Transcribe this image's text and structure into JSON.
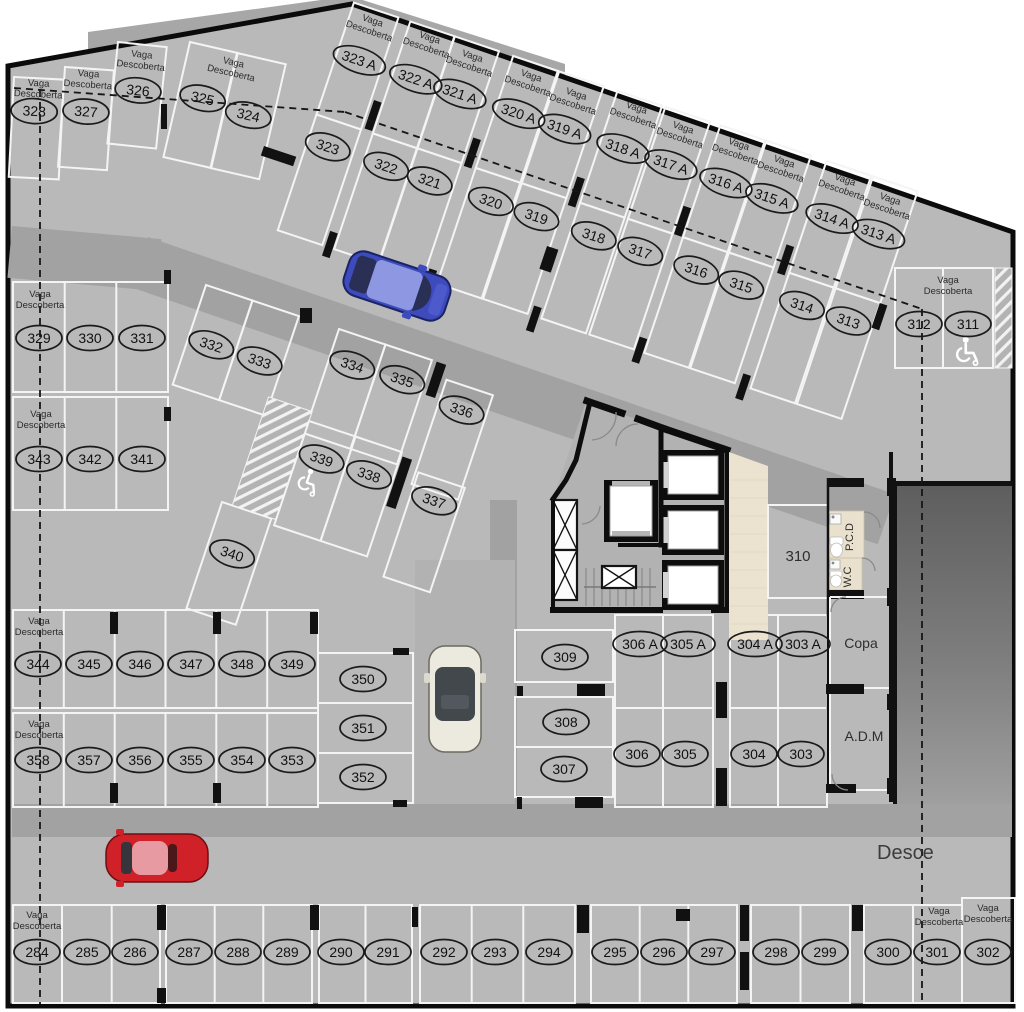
{
  "labels": {
    "uncovered_space": "Vaga Descoberta",
    "ramp_direction": "Desce"
  },
  "rooms": {
    "storage_unit": "310",
    "pantry": "Copa",
    "admin": "A.D.M",
    "wc": "W.C",
    "accessible_wc": "P.C.D"
  },
  "stalls": {
    "upper_left": [
      "328",
      "327",
      "326",
      "325",
      "324"
    ],
    "upper_row_outer": [
      "323 A",
      "322 A",
      "321 A",
      "320 A",
      "319 A",
      "318 A",
      "317 A",
      "316 A",
      "315 A",
      "314 A",
      "313 A"
    ],
    "upper_row_inner": [
      "323",
      "322",
      "321",
      "320",
      "319",
      "318",
      "317",
      "316",
      "315",
      "314",
      "313"
    ],
    "upper_right": [
      "312",
      "311"
    ],
    "mid_left_upper": [
      "329",
      "330",
      "331"
    ],
    "mid_left_lower": [
      "343",
      "342",
      "341"
    ],
    "diag_pair": [
      "332",
      "333"
    ],
    "diag_single": [
      "340"
    ],
    "diag_upper": [
      "334",
      "335",
      "336"
    ],
    "diag_lower": [
      "339",
      "338",
      "337"
    ],
    "lower_left_upper": [
      "344",
      "345",
      "346",
      "347",
      "348",
      "349"
    ],
    "lower_left_lower": [
      "358",
      "357",
      "356",
      "355",
      "354",
      "353"
    ],
    "lower_mid_stack": [
      "350",
      "351",
      "352"
    ],
    "center_stack": [
      "309",
      "308",
      "307"
    ],
    "center_block_a": [
      "306 A",
      "305 A",
      "306",
      "305"
    ],
    "center_block_b": [
      "304 A",
      "303 A",
      "304",
      "303"
    ],
    "bottom_row": [
      "284",
      "285",
      "286",
      "287",
      "288",
      "289",
      "290",
      "291",
      "292",
      "293",
      "294",
      "295",
      "296",
      "297",
      "298",
      "299",
      "300",
      "301",
      "302"
    ]
  },
  "accessible_stalls": [
    "339",
    "311"
  ]
}
